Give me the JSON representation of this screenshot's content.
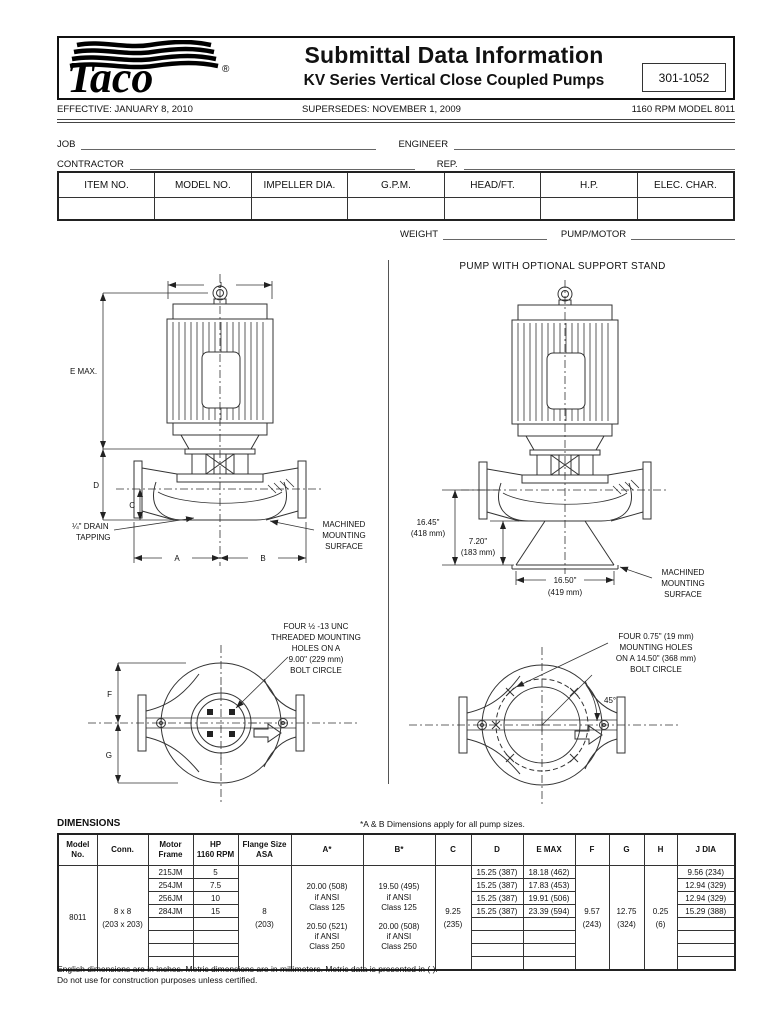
{
  "header": {
    "logo_text": "Taco",
    "logo_reg": "®",
    "title": "Submittal Data Information",
    "subtitle": "KV Series Vertical Close Coupled Pumps",
    "doc_number": "301-1052"
  },
  "meta": {
    "effective": "EFFECTIVE: JANUARY 8, 2010",
    "supersedes": "SUPERSEDES: NOVEMBER 1, 2009",
    "model": "1160 RPM MODEL 8011"
  },
  "form": {
    "job": "JOB",
    "engineer": "ENGINEER",
    "contractor": "CONTRACTOR",
    "rep": "REP.",
    "weight": "WEIGHT",
    "pump_motor": "PUMP/MOTOR"
  },
  "spec_table": {
    "headers": [
      "ITEM NO.",
      "MODEL NO.",
      "IMPELLER DIA.",
      "G.P.M.",
      "HEAD/FT.",
      "H.P.",
      "ELEC. CHAR."
    ]
  },
  "drawings": {
    "support_title": "PUMP WITH  OPTIONAL SUPPORT STAND",
    "front": {
      "j": "J",
      "e_max": "E MAX.",
      "d": "D",
      "c": "C",
      "a": "A",
      "b": "B",
      "drain": [
        "¼\" DRAIN",
        "TAPPING"
      ],
      "mount": [
        "MACHINED",
        "MOUNTING",
        "SURFACE"
      ]
    },
    "stand": {
      "height_total": "16.45\"",
      "height_total_mm": "(418 mm)",
      "stand_height": "7.20\"",
      "stand_height_mm": "(183 mm)",
      "base_width": "16.50\"",
      "base_width_mm": "(419 mm)",
      "mount": [
        "MACHINED",
        "MOUNTING",
        "SURFACE"
      ]
    },
    "plan_left": {
      "note": [
        "FOUR ½ -13 UNC",
        "THREADED MOUNTING",
        "HOLES ON A",
        "9.00\" (229 mm)",
        "BOLT CIRCLE"
      ],
      "f": "F",
      "g": "G"
    },
    "plan_right": {
      "note": [
        "FOUR 0.75\" (19 mm)",
        "MOUNTING HOLES",
        "ON A 14.50\" (368 mm)",
        "BOLT CIRCLE"
      ],
      "angle": "45°"
    }
  },
  "dim_table": {
    "title": "DIMENSIONS",
    "note": "*A & B Dimensions apply for all pump sizes.",
    "headers": [
      "Model\nNo.",
      "Conn.",
      "Motor\nFrame",
      "HP\n1160 RPM",
      "Flange Size\nASA",
      "A*",
      "B*",
      "C",
      "D",
      "E MAX",
      "F",
      "G",
      "H",
      "J DIA"
    ],
    "model_no": "8011",
    "conn": "8 x 8",
    "conn_mm": "(203 x 203)",
    "motor_frame": [
      "215JM",
      "254JM",
      "256JM",
      "284JM",
      "",
      "",
      "",
      ""
    ],
    "hp": [
      "5",
      "7.5",
      "10",
      "15",
      "",
      "",
      "",
      ""
    ],
    "flange": "8",
    "flange_mm": "(203)",
    "a1": "20.00 (508)\nif ANSI\nClass 125",
    "a2": "20.50 (521)\nif ANSI\nClass 250",
    "b1": "19.50 (495)\nif ANSI\nClass 125",
    "b2": "20.00 (508)\nif ANSI\nClass 250",
    "c": "9.25",
    "c_mm": "(235)",
    "d": [
      "15.25 (387)",
      "15.25 (387)",
      "15.25 (387)",
      "15.25 (387)",
      "",
      "",
      "",
      ""
    ],
    "e_max": [
      "18.18 (462)",
      "17.83 (453)",
      "19.91 (506)",
      "23.39 (594)",
      "",
      "",
      "",
      ""
    ],
    "f": "9.57",
    "f_mm": "(243)",
    "g": "12.75",
    "g_mm": "(324)",
    "h": "0.25",
    "h_mm": "(6)",
    "j_dia": [
      "9.56 (234)",
      "12.94 (329)",
      "12.94 (329)",
      "15.29 (388)",
      "",
      "",
      "",
      ""
    ]
  },
  "footnotes": [
    "English dimensions are in inches. Metric dimensions are in millimeters. Metric data is presented in (      ).",
    "Do not use for construction purposes unless certified."
  ]
}
